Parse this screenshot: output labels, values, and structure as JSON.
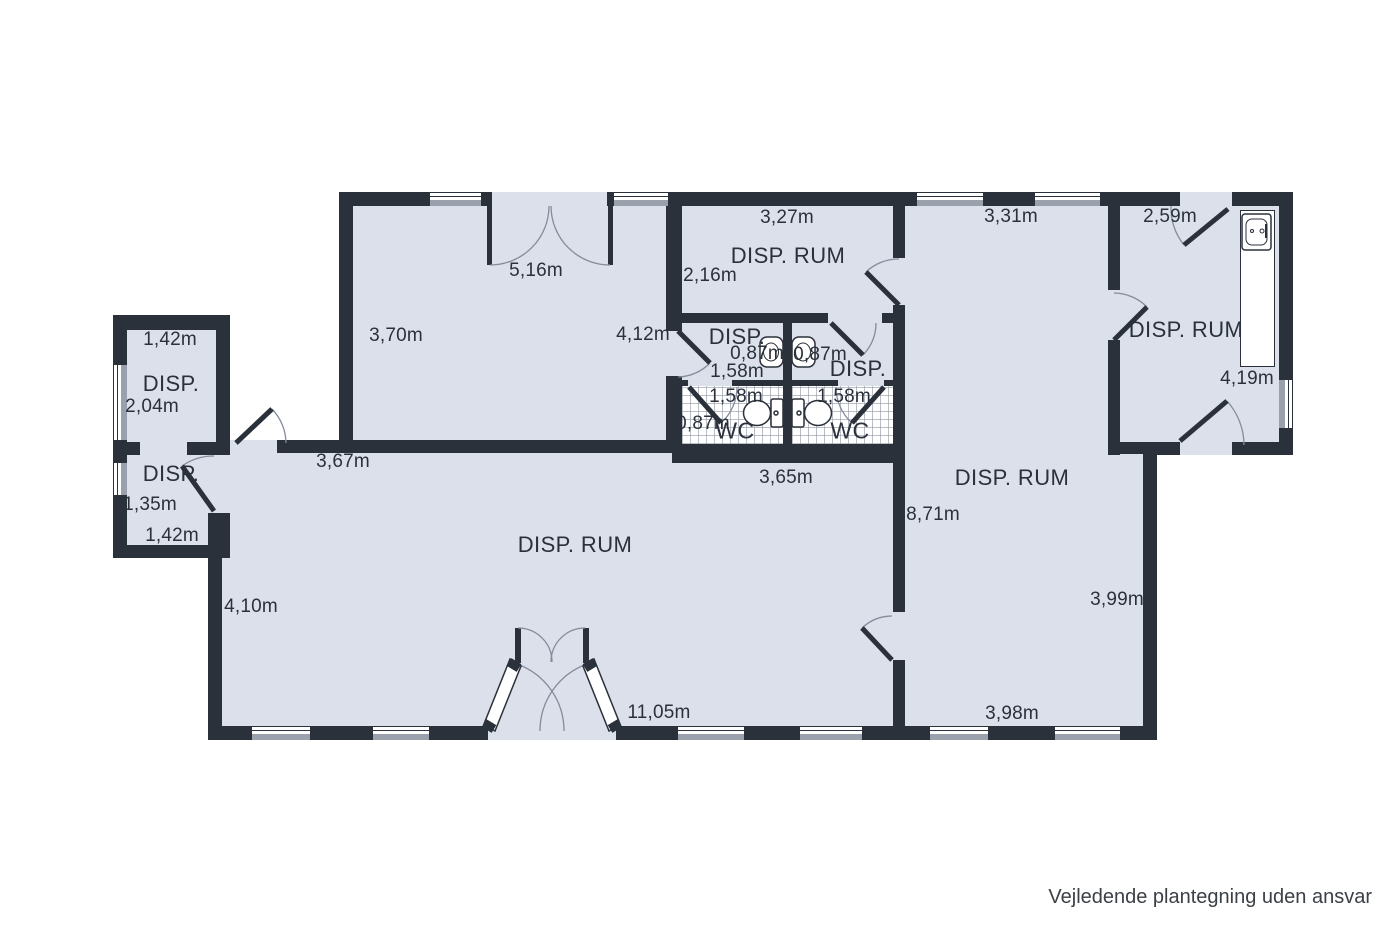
{
  "floorplan": {
    "disclaimer": "Vejledende plantegning uden ansvar",
    "labels": {
      "annex1_width": "1,42m",
      "annex1_name": "DISP.",
      "annex1_height": "2,04m",
      "annex2_name": "DISP.",
      "annex2_height": "1,35m",
      "annex2_width": "1,42m",
      "hall_door": "5,16m",
      "hall_left": "3,70m",
      "hall_bottom": "3,67m",
      "hall_right": "4,12m",
      "mid_top": "3,27m",
      "mid_name": "DISP. RUM",
      "mid_left": "2,16m",
      "vest_left_name": "DISP.",
      "vest_left_width": "0,87m",
      "vest_right_width": "0,87m",
      "vest_left_depth": "1,58m",
      "vest_right_name": "DISP.",
      "wc_left_depth": "1,58m",
      "wc_right_depth": "1,58m",
      "wc_left_width": "0,87m",
      "wc_left_name": "WC",
      "wc_right_name": "WC",
      "wc_bottom": "3,65m",
      "right_top": "3,31m",
      "tr_top": "2,59m",
      "tr_name": "DISP. RUM",
      "tr_right": "4,19m",
      "right_name": "DISP. RUM",
      "right_left": "8,71m",
      "right_right": "3,99m",
      "right_bottom": "3,98m",
      "main_name": "DISP. RUM",
      "main_left": "4,10m",
      "main_bottom": "11,05m"
    },
    "colors": {
      "wall": "#2b313a",
      "room_fill": "#dbe0eb",
      "sill": "#9ba1ac",
      "text": "#2b313a"
    }
  }
}
